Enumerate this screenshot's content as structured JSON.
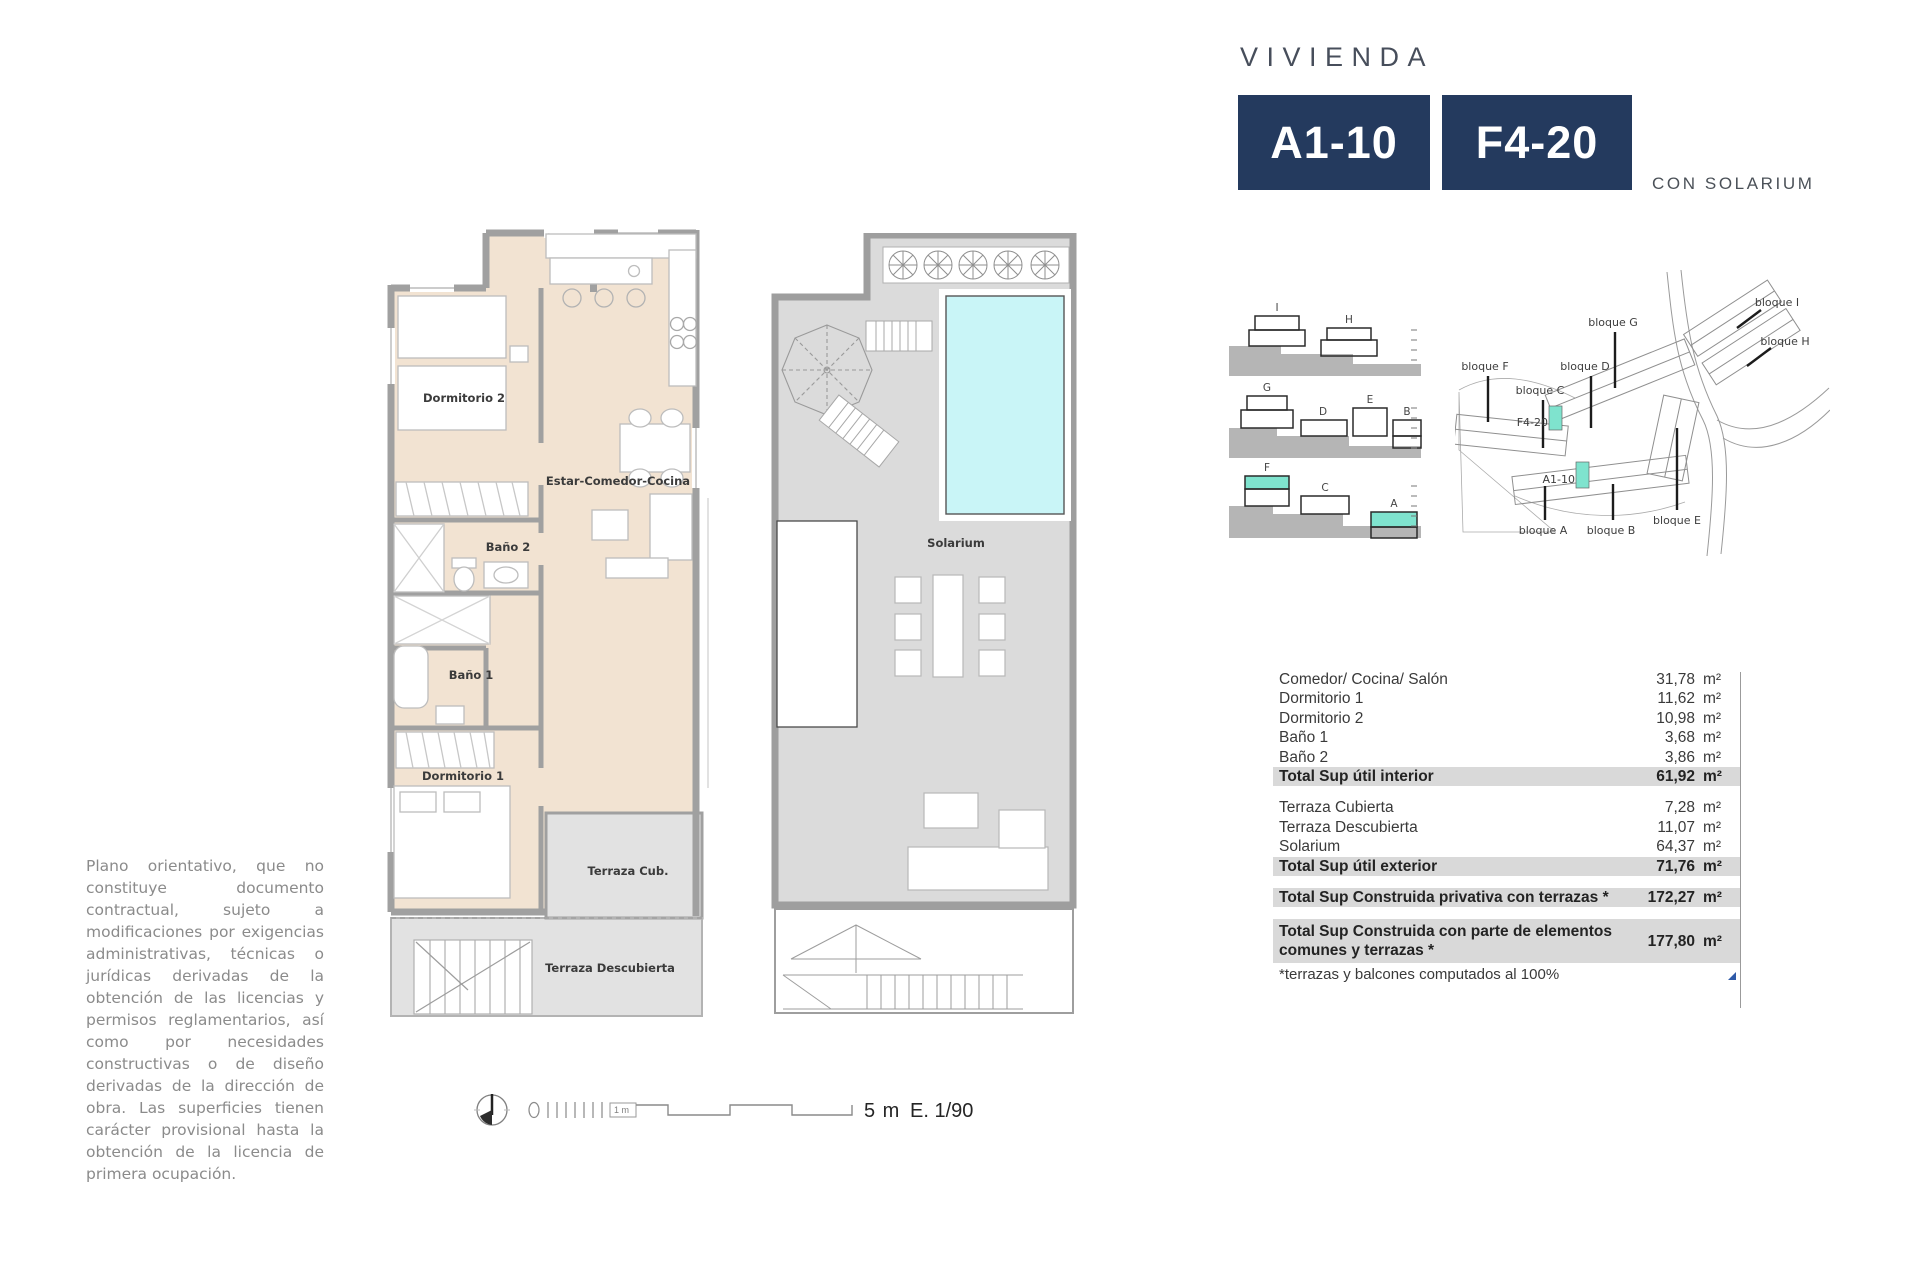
{
  "header": {
    "title": "VIVIENDA",
    "unit_a": "A1-10",
    "unit_f": "F4-20",
    "subtitle": "CON SOLARIUM",
    "badge_color": "#243a5e"
  },
  "floor_plan": {
    "rooms": {
      "dormitorio2": "Dormitorio 2",
      "estar": "Estar-Comedor-Cocina",
      "bano2": "Baño 2",
      "bano1": "Baño 1",
      "dormitorio1": "Dormitorio 1",
      "terraza_cub": "Terraza Cub.",
      "terraza_desc": "Terraza Descubierta",
      "solarium": "Solarium"
    },
    "colors": {
      "room_fill": "#f2e3d2",
      "terrace_fill": "#e2e2e2",
      "wall": "#a0a0a0",
      "pool_fill": "#c9f5f7"
    }
  },
  "elevations": {
    "rows": [
      [
        "I",
        "H"
      ],
      [
        "G",
        "D",
        "E",
        "B"
      ],
      [
        "F",
        "C",
        "A"
      ]
    ],
    "highlight_color": "#7fe3ce"
  },
  "site_map": {
    "blocks": {
      "f": "bloque F",
      "c": "bloque C",
      "g": "bloque G",
      "d": "bloque D",
      "i": "bloque I",
      "h": "bloque H",
      "a": "bloque A",
      "b": "bloque B",
      "e": "bloque E"
    },
    "units": {
      "f4": "F4-20",
      "a1": "A1-10"
    },
    "highlight_color": "#7fe3ce"
  },
  "area_table": {
    "unit": "m²",
    "interior": {
      "rows": [
        {
          "label": "Comedor/ Cocina/ Salón",
          "value": "31,78"
        },
        {
          "label": "Dormitorio 1",
          "value": "11,62"
        },
        {
          "label": "Dormitorio 2",
          "value": "10,98"
        },
        {
          "label": "Baño 1",
          "value": "3,68"
        },
        {
          "label": "Baño 2",
          "value": "3,86"
        }
      ],
      "total": {
        "label": "Total Sup útil interior",
        "value": "61,92"
      }
    },
    "exterior": {
      "rows": [
        {
          "label": "Terraza Cubierta",
          "value": "7,28"
        },
        {
          "label": "Terraza Descubierta",
          "value": "11,07"
        },
        {
          "label": "Solarium",
          "value": "64,37"
        }
      ],
      "total": {
        "label": "Total Sup útil exterior",
        "value": "71,76"
      }
    },
    "construida": [
      {
        "label": "Total Sup Construida privativa con terrazas *",
        "value": "172,27"
      },
      {
        "label": "Total Sup Construida con parte de elementos comunes y terrazas *",
        "value": "177,80"
      }
    ],
    "footnote": "*terrazas y balcones computados al 100%"
  },
  "disclaimer": "Plano orientativo, que no constituye documento contractual, sujeto a modificaciones por exigencias administrativas, técnicas o jurídicas derivadas de la obtención de las licencias y permisos reglamentarios, así como por necesidades constructivas o de diseño derivadas de la dirección de obra. Las superficies tienen carácter provisional hasta la obtención de la licencia de primera ocupación.",
  "scale_bar": {
    "label_1m": "1 m",
    "label_5m": "5 m",
    "scale_text": "E. 1/90"
  }
}
